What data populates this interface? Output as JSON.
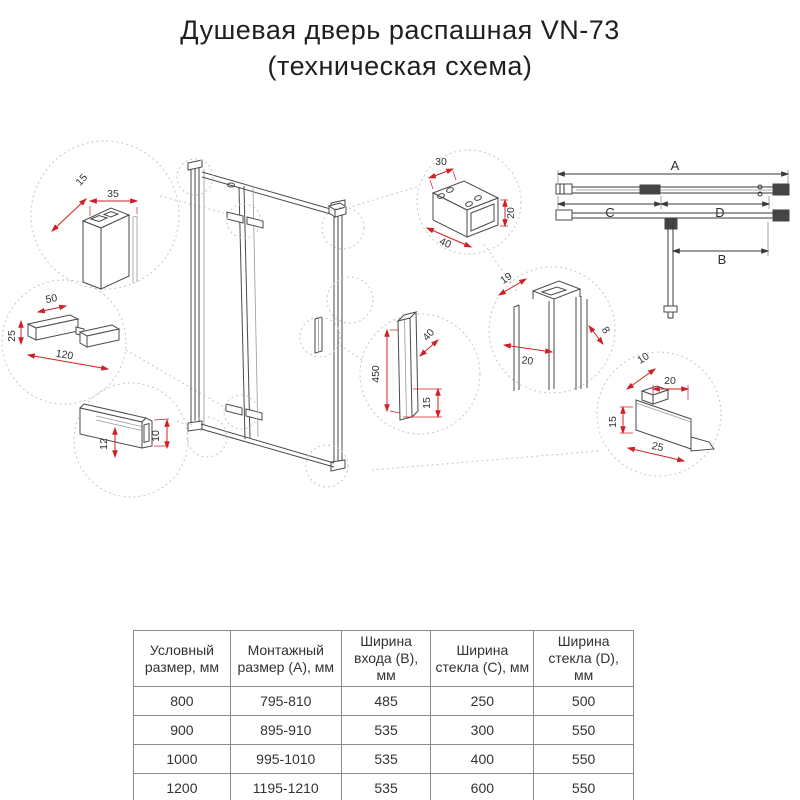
{
  "title": {
    "line1": "Душевая дверь распашная VN-73",
    "line2": "(техническая схема)"
  },
  "colors": {
    "dimension_red": "#cf2027",
    "drawing_line": "#4a4a4a",
    "dashed_circle": "#c6c6c6",
    "table_border": "#8c8c8c",
    "text": "#333333"
  },
  "dims": {
    "wall_depth": "15",
    "wall_width": "35",
    "hinge_top": "50",
    "hinge_height": "25",
    "hinge_length": "120",
    "channel_inner": "12",
    "channel_height": "10",
    "bracket_width": "30",
    "bracket_length": "40",
    "bracket_height": "20",
    "jamb_a": "19",
    "jamb_b": "20",
    "jamb_c": "8",
    "handle_length": "450",
    "handle_depth": "40",
    "handle_offset": "15",
    "holder_a": "10",
    "holder_b": "20",
    "holder_c": "15",
    "holder_d": "25"
  },
  "plan": {
    "a": "A",
    "b": "B",
    "c": "C",
    "d": "D"
  },
  "table": {
    "headers": [
      "Условный размер, мм",
      "Монтажный размер (А), мм",
      "Ширина входа (В), мм",
      "Ширина стекла (С), мм",
      "Ширина стекла (D), мм"
    ],
    "rows": [
      [
        "800",
        "795-810",
        "485",
        "250",
        "500"
      ],
      [
        "900",
        "895-910",
        "535",
        "300",
        "550"
      ],
      [
        "1000",
        "995-1010",
        "535",
        "400",
        "550"
      ],
      [
        "1200",
        "1195-1210",
        "535",
        "600",
        "550"
      ]
    ]
  }
}
